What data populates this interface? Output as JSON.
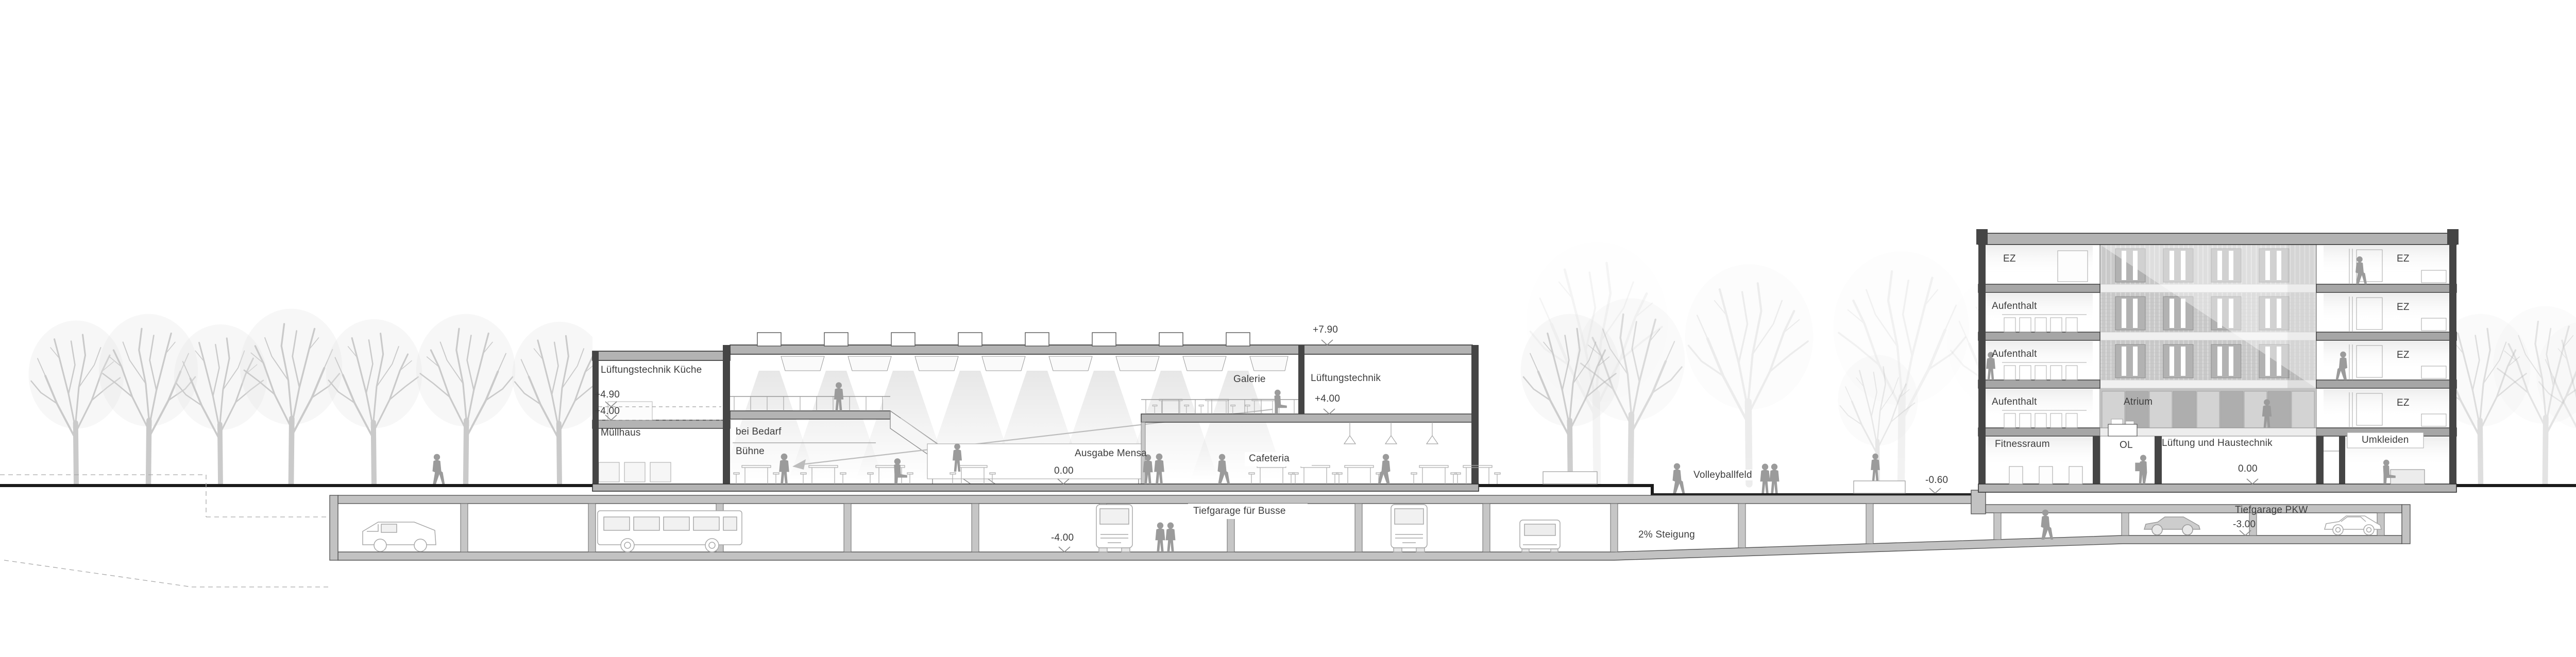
{
  "drawing": {
    "kind": "architectural longitudinal section",
    "language": "de",
    "ground_reference": "0.00"
  },
  "colors": {
    "line": "#9a9a9a",
    "wall_cut": "#454545",
    "slab": "#b3b3b3",
    "ground_line": "#1b1b1b",
    "figure": "#9b9b9b",
    "text": "#3d3d3d",
    "tree": "#bdbdbd",
    "facade_slats": "#c9c9c9"
  },
  "labels": {
    "annex": {
      "kitchen_vent": "Lüftungstechnik Küche",
      "level_490": "+4.90",
      "level_400": "+4.00",
      "trash_house": "Müllhaus"
    },
    "hall": {
      "stage_line1": "bei Bedarf",
      "stage_line2": "Bühne",
      "gallery": "Galerie",
      "vent": "Lüftungstechnik",
      "level_790": "+7.90",
      "level_400": "+4.00",
      "serving": "Ausgabe Mensa",
      "level_0": "0.00",
      "cafeteria": "Cafeteria"
    },
    "site": {
      "volleyball": "Volleyballfeld",
      "level_m060": "-0.60"
    },
    "garage": {
      "bus": "Tiefgarage für Busse",
      "level_m400": "-4.00",
      "slope": "2% Steigung",
      "cars": "Tiefgarage PKW",
      "level_m300": "-3.00"
    },
    "tower": {
      "floor4": {
        "left": "EZ",
        "right": "EZ"
      },
      "floor3": {
        "left": "Aufenthalt",
        "right": "EZ"
      },
      "floor2": {
        "left": "Aufenthalt",
        "right": "EZ"
      },
      "floor1": {
        "left": "Aufenthalt",
        "mid": "Atrium",
        "right": "EZ"
      },
      "ground": {
        "fitness": "Fitnessraum",
        "ol": "OL",
        "tech": "Lüftung und Haustechnik",
        "level_0": "0.00",
        "changing": "Umkleiden"
      }
    }
  }
}
